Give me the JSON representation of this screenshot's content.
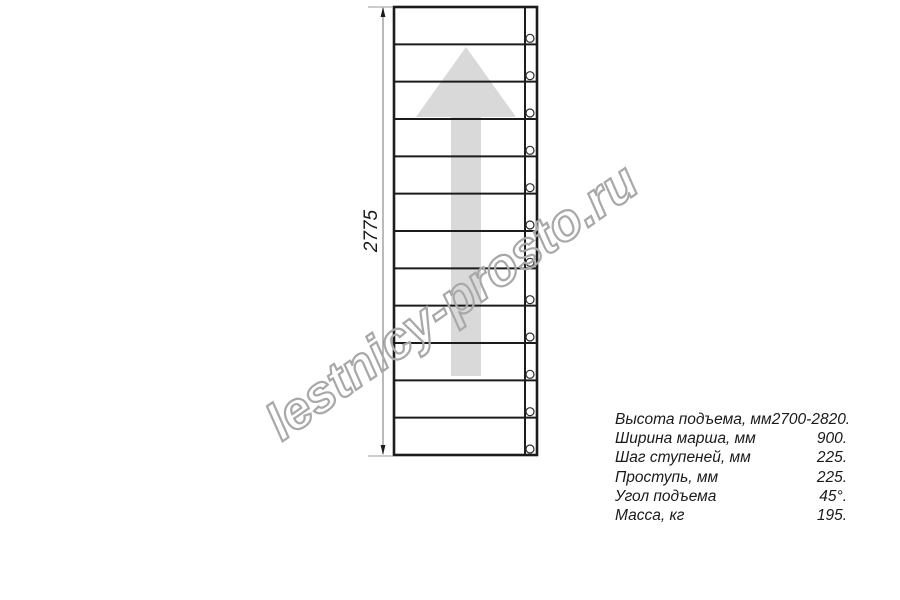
{
  "watermark": {
    "text": "lestnicy-prosto.ru",
    "color": "#a8a8a8"
  },
  "drawing": {
    "title_semantic": "straight staircase flight plan view",
    "dimension_label": "2775",
    "steps": 12,
    "direction_arrow": "up",
    "line_color": "#1c1c1c",
    "arrow_color": "#d9d9d9",
    "dim_line_color": "#8c8c8c",
    "hole_stroke_color": "#2a2a2a"
  },
  "specs": {
    "rows": [
      {
        "label": "Высота подъема, мм",
        "value": "2700-2820."
      },
      {
        "label": "Ширина марша, мм",
        "value": "900."
      },
      {
        "label": "Шаг ступеней, мм",
        "value": "225."
      },
      {
        "label": "Проступь, мм",
        "value": "225."
      },
      {
        "label": "Угол подъема",
        "value": "45°."
      },
      {
        "label": "Масса, кг",
        "value": "195."
      }
    ]
  }
}
